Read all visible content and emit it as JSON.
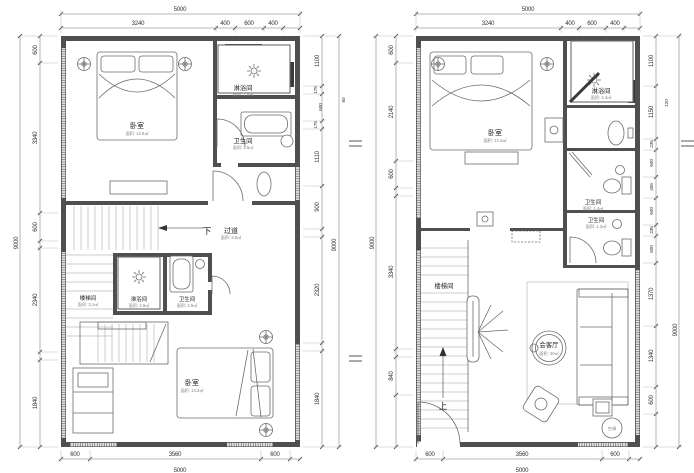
{
  "lp": {
    "top_total": "5000",
    "top_segs": [
      "3240",
      "400",
      "600",
      "400"
    ],
    "bottom_segs": [
      "600",
      "3560",
      "600"
    ],
    "bottom_total": "5000",
    "left_total": "9000",
    "left_segs": [
      "600",
      "3340",
      "600",
      "2340",
      "1840"
    ],
    "right_total": "9000",
    "right_segs": [
      "1100",
      "175",
      "600",
      "175",
      "1110",
      "900",
      "2320",
      "1840"
    ],
    "right_note": "60",
    "rooms": {
      "bedroom_top": {
        "name": "卧室",
        "area": "面积: 12.6㎡"
      },
      "shower_top": {
        "name": "淋浴间",
        "area": "面积: 1.8㎡"
      },
      "bath_top": {
        "name": "卫生间",
        "area": "面积: 2.5㎡"
      },
      "corridor": {
        "name": "过道",
        "area": "面积: 3.0㎡",
        "down": "下"
      },
      "stair": {
        "name": "楼梯间",
        "area": "面积: 3.1㎡"
      },
      "shower_mid": {
        "name": "淋浴间",
        "area": "面积: 2.6㎡"
      },
      "bath_mid": {
        "name": "卫生间",
        "area": "面积: 2.5㎡"
      },
      "bedroom_bottom": {
        "name": "卧室",
        "area": "面积: 14.3㎡"
      }
    }
  },
  "rp": {
    "top_total": "5000",
    "top_segs": [
      "3240",
      "400",
      "600",
      "400"
    ],
    "bottom_segs": [
      "600",
      "3560",
      "600"
    ],
    "bottom_total": "5000",
    "left_total": "9000",
    "left_segs": [
      "600",
      "2140",
      "600",
      "3340",
      "840"
    ],
    "right_total": "9000",
    "right_segs": [
      "1100",
      "1150",
      "235",
      "600",
      "455",
      "600",
      "235",
      "600",
      "1370",
      "1340",
      "600"
    ],
    "right_note": "120",
    "rooms": {
      "bedroom": {
        "name": "卧室",
        "area": "面积: 12.4㎡"
      },
      "shower": {
        "name": "淋浴间",
        "area": "面积: 2.4㎡"
      },
      "bath_upper": {
        "name": "卫生间",
        "area": "面积: 1.4㎡"
      },
      "bath_lower": {
        "name": "卫生间",
        "area": "面积: 1.3㎡"
      },
      "stair": {
        "name": "楼梯间"
      },
      "living": {
        "name": "会客厅",
        "area": "面积: 20㎡"
      },
      "ac": {
        "name": "空调"
      },
      "up": "上"
    }
  }
}
